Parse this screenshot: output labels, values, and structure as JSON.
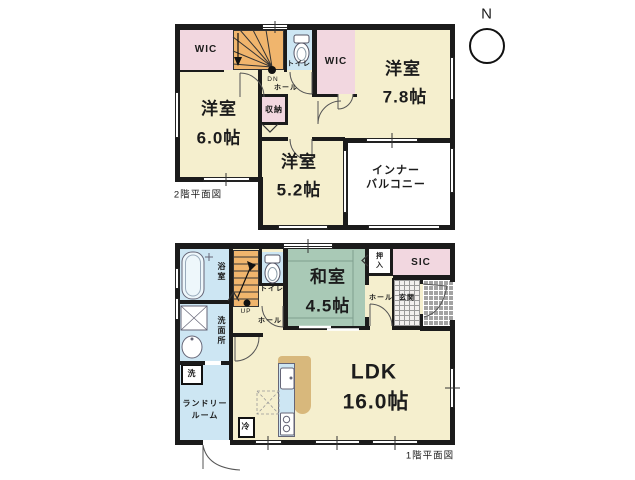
{
  "compass": {
    "north_label": "N"
  },
  "colors": {
    "wall": "#1b1b1b",
    "cream": "#f5efce",
    "pink": "#f2d7e0",
    "blue": "#cde6f3",
    "green": "#a9c9b6",
    "orange": "#f0b56d",
    "tan": "#d8b87c"
  },
  "floor2": {
    "caption": "2階平面図",
    "wic1": "WIC",
    "toilet": "トイレ",
    "wic2": "WIC",
    "dn": "DN",
    "hall": "ホール",
    "room78_name": "洋室",
    "room78_size": "7.8帖",
    "room60_name": "洋室",
    "room60_size": "6.0帖",
    "storage": "収納",
    "room52_name": "洋室",
    "room52_size": "5.2帖",
    "balcony_line1": "インナー",
    "balcony_line2": "バルコニー"
  },
  "floor1": {
    "caption": "1階平面図",
    "bath": "浴室",
    "toilet": "トイレ",
    "up": "UP",
    "hall_left": "ホール",
    "washroom": "洗面所",
    "washer": "洗",
    "laundry_line1": "ランドリー",
    "laundry_line2": "ルーム",
    "fridge": "冷",
    "washitsu_name": "和室",
    "washitsu_size": "4.5帖",
    "oshiire": "押入",
    "sic": "SIC",
    "hall_right": "ホール",
    "genkan": "玄関",
    "ldk_name": "LDK",
    "ldk_size": "16.0帖"
  }
}
